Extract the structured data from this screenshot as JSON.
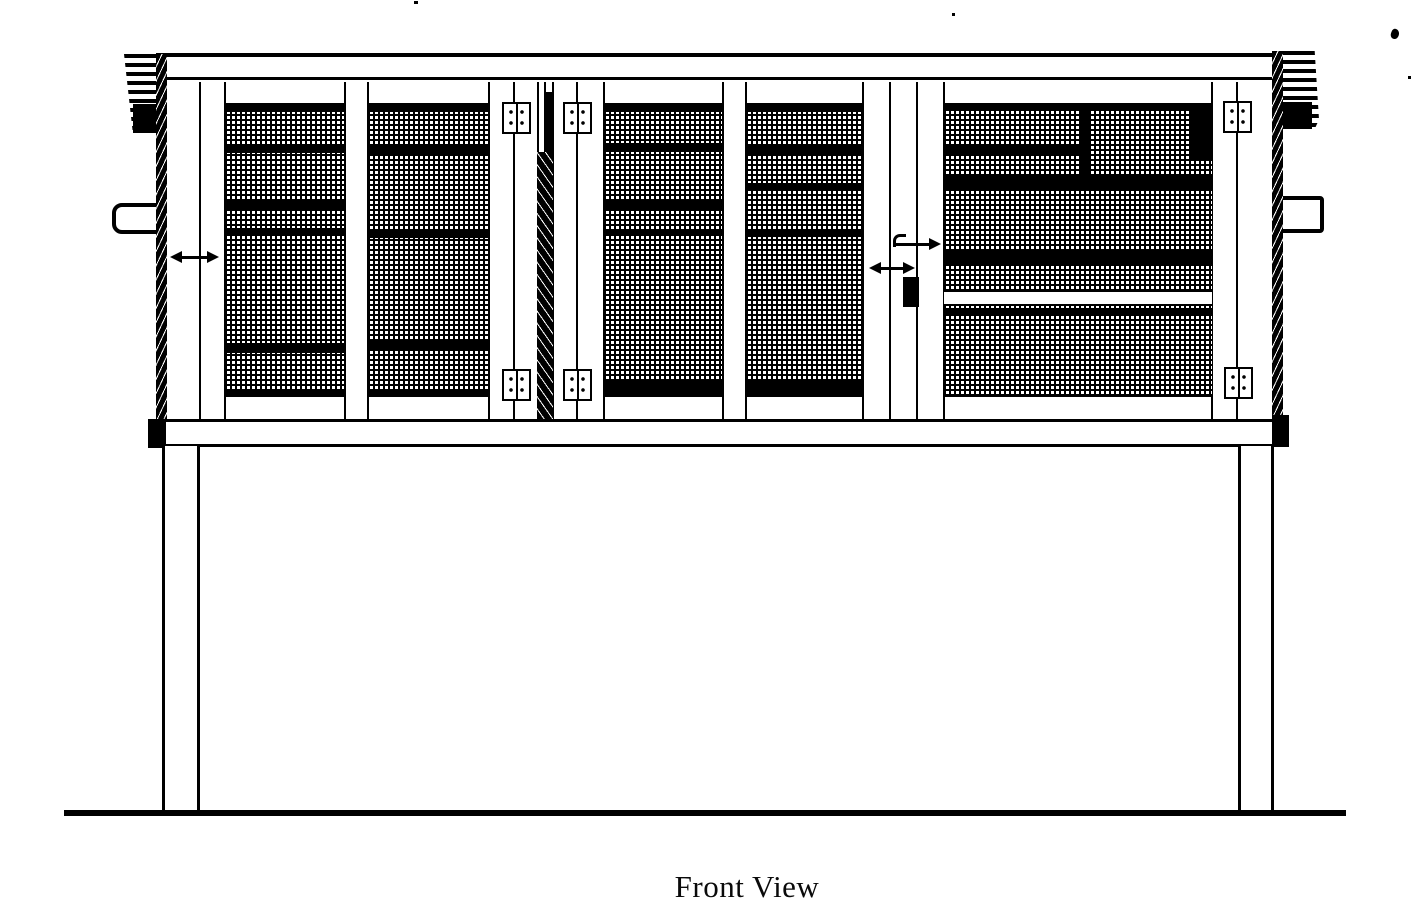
{
  "caption": {
    "text": "Front View"
  },
  "diagram": {
    "type": "scanned technical line drawing",
    "subject": "elevated wire-mesh hutch, front elevation",
    "ink_color": "#000000",
    "paper_color": "#ffffff",
    "panels": [
      "left mesh panel 1",
      "left mesh panel 2",
      "center double-door mesh panel left",
      "center double-door mesh panel right",
      "right mesh door with interior shelf and white board strip"
    ],
    "hardware": [
      "hinge plate x6",
      "black latch block",
      "door swing arrow x3",
      "side cleat x2",
      "striped roof overhang ends x2"
    ]
  }
}
